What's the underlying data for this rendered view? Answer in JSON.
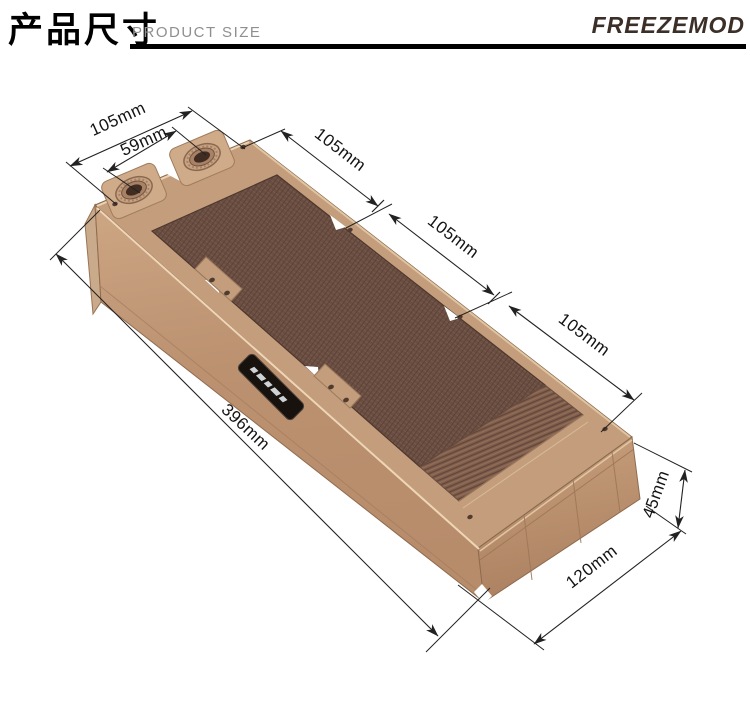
{
  "header": {
    "title_zh": "产品尺寸",
    "title_en": "PRODUCT SIZE",
    "brand": "FREEZEMOD"
  },
  "diagram": {
    "type": "isometric-product-dimension-drawing",
    "dimensions": {
      "end_screw_spacing": "105mm",
      "port_spacing": "59mm",
      "fan_pitch_1": "105mm",
      "fan_pitch_2": "105mm",
      "fan_pitch_3": "105mm",
      "length": "396mm",
      "height": "45mm",
      "width": "120mm"
    },
    "colors": {
      "frame": "#c49e7c",
      "frame_light": "#cfab8a",
      "core": "#6b4e42",
      "fins": "#7d5c4c",
      "dimension_line": "#222222",
      "brand_text": "#3b2f27",
      "badge": "#17120e"
    }
  }
}
